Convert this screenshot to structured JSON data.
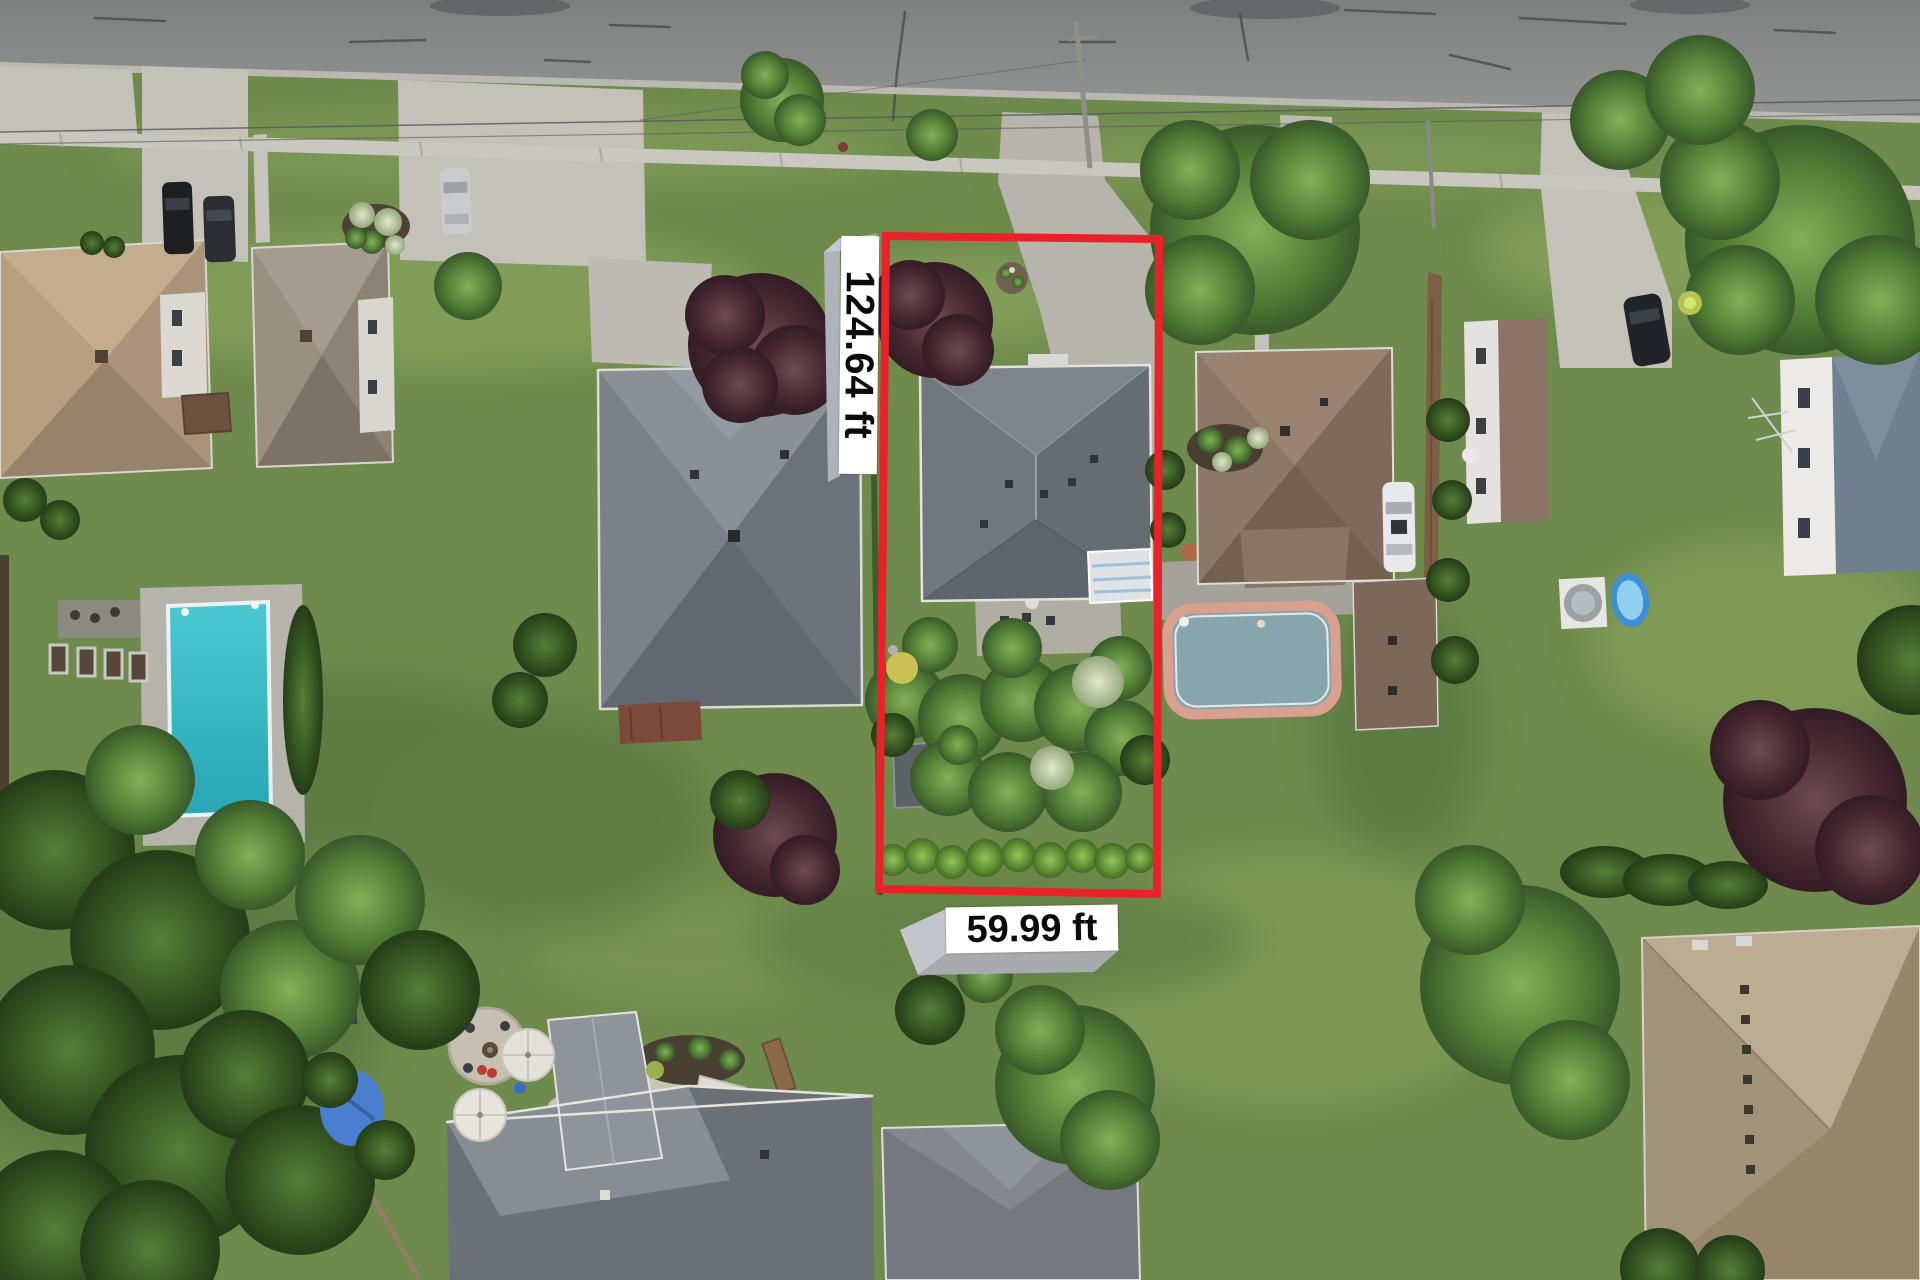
{
  "scene": {
    "type": "aerial-drone-photo",
    "subject": "residential-lot-with-boundary-overlay",
    "road_position": "top"
  },
  "annotations": {
    "depth_label": "124.64 ft",
    "width_label": "59.99 ft",
    "label_background": "#ffffff",
    "label_text_color": "#0b0b0b",
    "label_extrusion_color": "#b4b9bf",
    "boundary_color": "#e82228"
  },
  "palette": {
    "road_asphalt": "#8b8d8c",
    "concrete": "#c3c1b8",
    "grass": "#6e8a4c",
    "tree_green": "#4e7a33",
    "tree_maroon": "#5a3742",
    "roof_gray": "#6e747b",
    "roof_brown": "#8a7263",
    "roof_tan": "#b2a184",
    "pool_teal": "#3bbcc9",
    "pool_gray_blue": "#87a5ad",
    "pool_coping_salmon": "#d9a090",
    "kiddie_pool_blue": "#4a9ade"
  }
}
